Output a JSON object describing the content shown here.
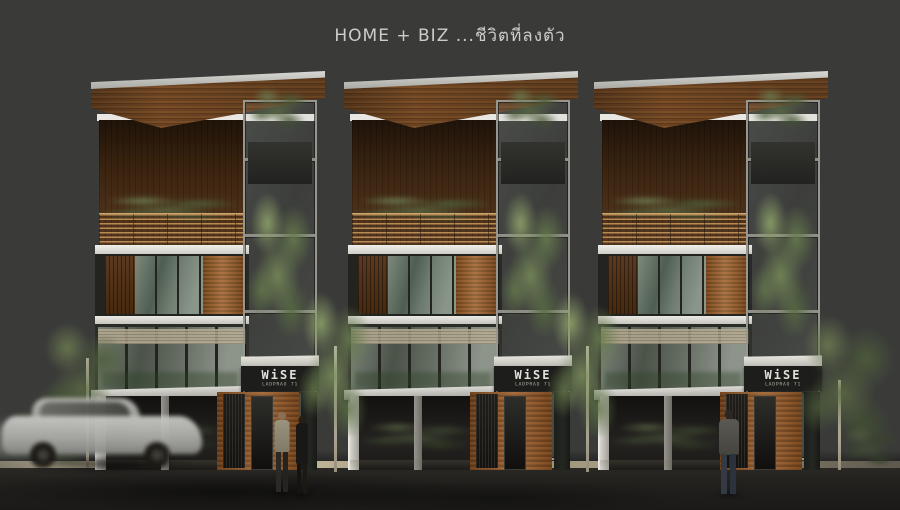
{
  "title": "HOME + BIZ ...ชีวิตที่ลงตัว",
  "project": {
    "sign_name": "WiSE",
    "sign_subtext": "LADPRAO 71"
  },
  "scene": {
    "description": "Front elevation rendering of three identical modern 4-storey HOME+BIZ shophouses with timber panels, glass stair atriums with trees, rooftop terraces, WiSE signage, street trees, pedestrians and a passing car",
    "building_count": 3
  },
  "colors": {
    "background": "#3a3b39",
    "roof_wood": "#6b4423",
    "panel_wood": "#9a5c28",
    "glass_green": "#5c695c",
    "white_trim": "#e8e7e2",
    "foliage": "#73855a",
    "street": "#21201d",
    "curb": "#cfc3a2",
    "sign_bg": "#1d1d1b",
    "sign_text": "#ecece6",
    "title_text": "#cccccb"
  }
}
